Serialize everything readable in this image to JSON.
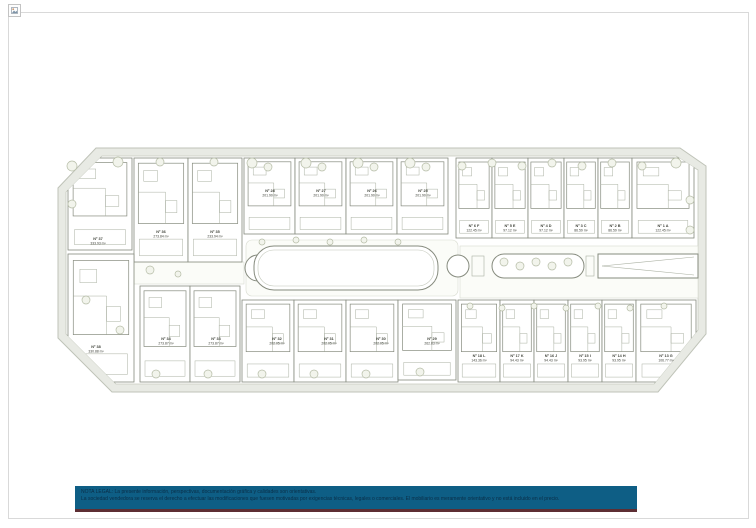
{
  "colors": {
    "frame": "#d9d9d9",
    "plan_band": "#e8eae4",
    "plan_line": "#868b7e",
    "plan_detail": "#aab0a2",
    "tree": "#b5bca6",
    "label": "#3e4138",
    "legal_bg": "#0e5e85",
    "legal_accent": "#5d2e33",
    "legal_text": "#0a2e47"
  },
  "icons": {
    "broken_image": "broken-image-icon"
  },
  "legal_note": {
    "line1": "NOTA LEGAL: La presente información, perspectivas, documentación gráfica y calidades son orientativas.",
    "line2": "La sociedad vendedora se reserva el derecho a efectuar las modificaciones que fuesen motivadas por exigencias técnicas, legales o comerciales. El mobiliario es meramente orientativo y no está incluido en el precio."
  },
  "plan": {
    "units": [
      {
        "id": "Nº 37",
        "area": "333.93 m²",
        "rect": [
          68,
          158,
          64,
          92
        ],
        "label": [
          98,
          240
        ]
      },
      {
        "id": "Nº 36",
        "area": "273.84 m²",
        "rect": [
          134,
          158,
          54,
          104
        ],
        "label": [
          161,
          233
        ]
      },
      {
        "id": "Nº 35",
        "area": "233.94 m²",
        "rect": [
          188,
          158,
          54,
          104
        ],
        "label": [
          215,
          233
        ]
      },
      {
        "id": "Nº 28",
        "area": "201.90 m²",
        "rect": [
          244,
          158,
          51,
          76
        ],
        "label": [
          270,
          192
        ]
      },
      {
        "id": "Nº 27",
        "area": "201.90 m²",
        "rect": [
          295,
          158,
          51,
          76
        ],
        "label": [
          321,
          192
        ]
      },
      {
        "id": "Nº 26",
        "area": "201.90 m²",
        "rect": [
          346,
          158,
          51,
          76
        ],
        "label": [
          372,
          192
        ]
      },
      {
        "id": "Nº 25",
        "area": "201.90 m²",
        "rect": [
          397,
          158,
          51,
          76
        ],
        "label": [
          423,
          192
        ]
      },
      {
        "id": "Nº 6 F",
        "area": "122.45 m²",
        "rect": [
          456,
          158,
          36,
          80
        ],
        "label": [
          474,
          227
        ]
      },
      {
        "id": "Nº 5 E",
        "area": "97.12 m²",
        "rect": [
          492,
          158,
          36,
          80
        ],
        "label": [
          510,
          227
        ]
      },
      {
        "id": "Nº 4 D",
        "area": "97.12 m²",
        "rect": [
          528,
          158,
          36,
          80
        ],
        "label": [
          546,
          227
        ]
      },
      {
        "id": "Nº 3 C",
        "area": "86.59 m²",
        "rect": [
          564,
          158,
          34,
          80
        ],
        "label": [
          581,
          227
        ]
      },
      {
        "id": "Nº 2 B",
        "area": "86.59 m²",
        "rect": [
          598,
          158,
          34,
          80
        ],
        "label": [
          615,
          227
        ]
      },
      {
        "id": "Nº 1 A",
        "area": "122.45 m²",
        "rect": [
          632,
          158,
          62,
          80
        ],
        "label": [
          663,
          227
        ]
      },
      {
        "id": "Nº 38",
        "area": "330.88 m²",
        "rect": [
          68,
          254,
          66,
          128
        ],
        "label": [
          96,
          348
        ]
      },
      {
        "id": "Nº 34",
        "area": "273.87 m²",
        "rect": [
          140,
          286,
          50,
          96
        ],
        "label": [
          166,
          340
        ]
      },
      {
        "id": "Nº 33",
        "area": "273.87 m²",
        "rect": [
          190,
          286,
          50,
          96
        ],
        "label": [
          216,
          340
        ]
      },
      {
        "id": "Nº 32",
        "area": "202.05 m²",
        "rect": [
          242,
          300,
          52,
          82
        ],
        "label": [
          277,
          340
        ]
      },
      {
        "id": "Nº 31",
        "area": "202.05 m²",
        "rect": [
          294,
          300,
          52,
          82
        ],
        "label": [
          329,
          340
        ]
      },
      {
        "id": "Nº 30",
        "area": "202.05 m²",
        "rect": [
          346,
          300,
          52,
          82
        ],
        "label": [
          381,
          340
        ]
      },
      {
        "id": "Nº 29",
        "area": "262.83 m²",
        "rect": [
          398,
          300,
          58,
          80
        ],
        "label": [
          432,
          340
        ]
      },
      {
        "id": "Nº 18 L",
        "area": "143.36 m²",
        "rect": [
          458,
          300,
          42,
          82
        ],
        "label": [
          479,
          357
        ]
      },
      {
        "id": "Nº 17 K",
        "area": "94.43 m²",
        "rect": [
          500,
          300,
          34,
          82
        ],
        "label": [
          517,
          357
        ]
      },
      {
        "id": "Nº 16 J",
        "area": "94.43 m²",
        "rect": [
          534,
          300,
          34,
          82
        ],
        "label": [
          551,
          357
        ]
      },
      {
        "id": "Nº 15 I",
        "area": "93.95 m²",
        "rect": [
          568,
          300,
          34,
          82
        ],
        "label": [
          585,
          357
        ]
      },
      {
        "id": "Nº 14 H",
        "area": "93.95 m²",
        "rect": [
          602,
          300,
          34,
          82
        ],
        "label": [
          619,
          357
        ]
      },
      {
        "id": "Nº 13 G",
        "area": "106.77 m²",
        "rect": [
          636,
          300,
          60,
          82
        ],
        "label": [
          666,
          357
        ]
      }
    ],
    "trees": [
      [
        72,
        166,
        5
      ],
      [
        72,
        204,
        4
      ],
      [
        118,
        162,
        5
      ],
      [
        160,
        162,
        4
      ],
      [
        214,
        162,
        4
      ],
      [
        252,
        163,
        5
      ],
      [
        268,
        167,
        4
      ],
      [
        306,
        163,
        5
      ],
      [
        322,
        167,
        4
      ],
      [
        358,
        163,
        5
      ],
      [
        374,
        167,
        4
      ],
      [
        410,
        163,
        5
      ],
      [
        426,
        167,
        4
      ],
      [
        462,
        166,
        4
      ],
      [
        492,
        163,
        4
      ],
      [
        522,
        166,
        4
      ],
      [
        552,
        163,
        4
      ],
      [
        582,
        166,
        4
      ],
      [
        612,
        163,
        4
      ],
      [
        642,
        166,
        4
      ],
      [
        676,
        163,
        5
      ],
      [
        262,
        242,
        3
      ],
      [
        296,
        240,
        3
      ],
      [
        330,
        242,
        3
      ],
      [
        364,
        240,
        3
      ],
      [
        398,
        242,
        3
      ],
      [
        504,
        262,
        4
      ],
      [
        520,
        266,
        4
      ],
      [
        536,
        262,
        4
      ],
      [
        552,
        266,
        4
      ],
      [
        568,
        262,
        4
      ],
      [
        86,
        300,
        4
      ],
      [
        120,
        330,
        4
      ],
      [
        150,
        270,
        4
      ],
      [
        178,
        274,
        3
      ],
      [
        156,
        374,
        4
      ],
      [
        208,
        374,
        4
      ],
      [
        262,
        374,
        4
      ],
      [
        314,
        374,
        4
      ],
      [
        366,
        374,
        4
      ],
      [
        420,
        372,
        4
      ],
      [
        470,
        306,
        3
      ],
      [
        502,
        308,
        3
      ],
      [
        534,
        306,
        3
      ],
      [
        566,
        308,
        3
      ],
      [
        598,
        306,
        3
      ],
      [
        630,
        308,
        3
      ],
      [
        664,
        306,
        3
      ],
      [
        690,
        200,
        4
      ],
      [
        690,
        230,
        4
      ]
    ]
  }
}
